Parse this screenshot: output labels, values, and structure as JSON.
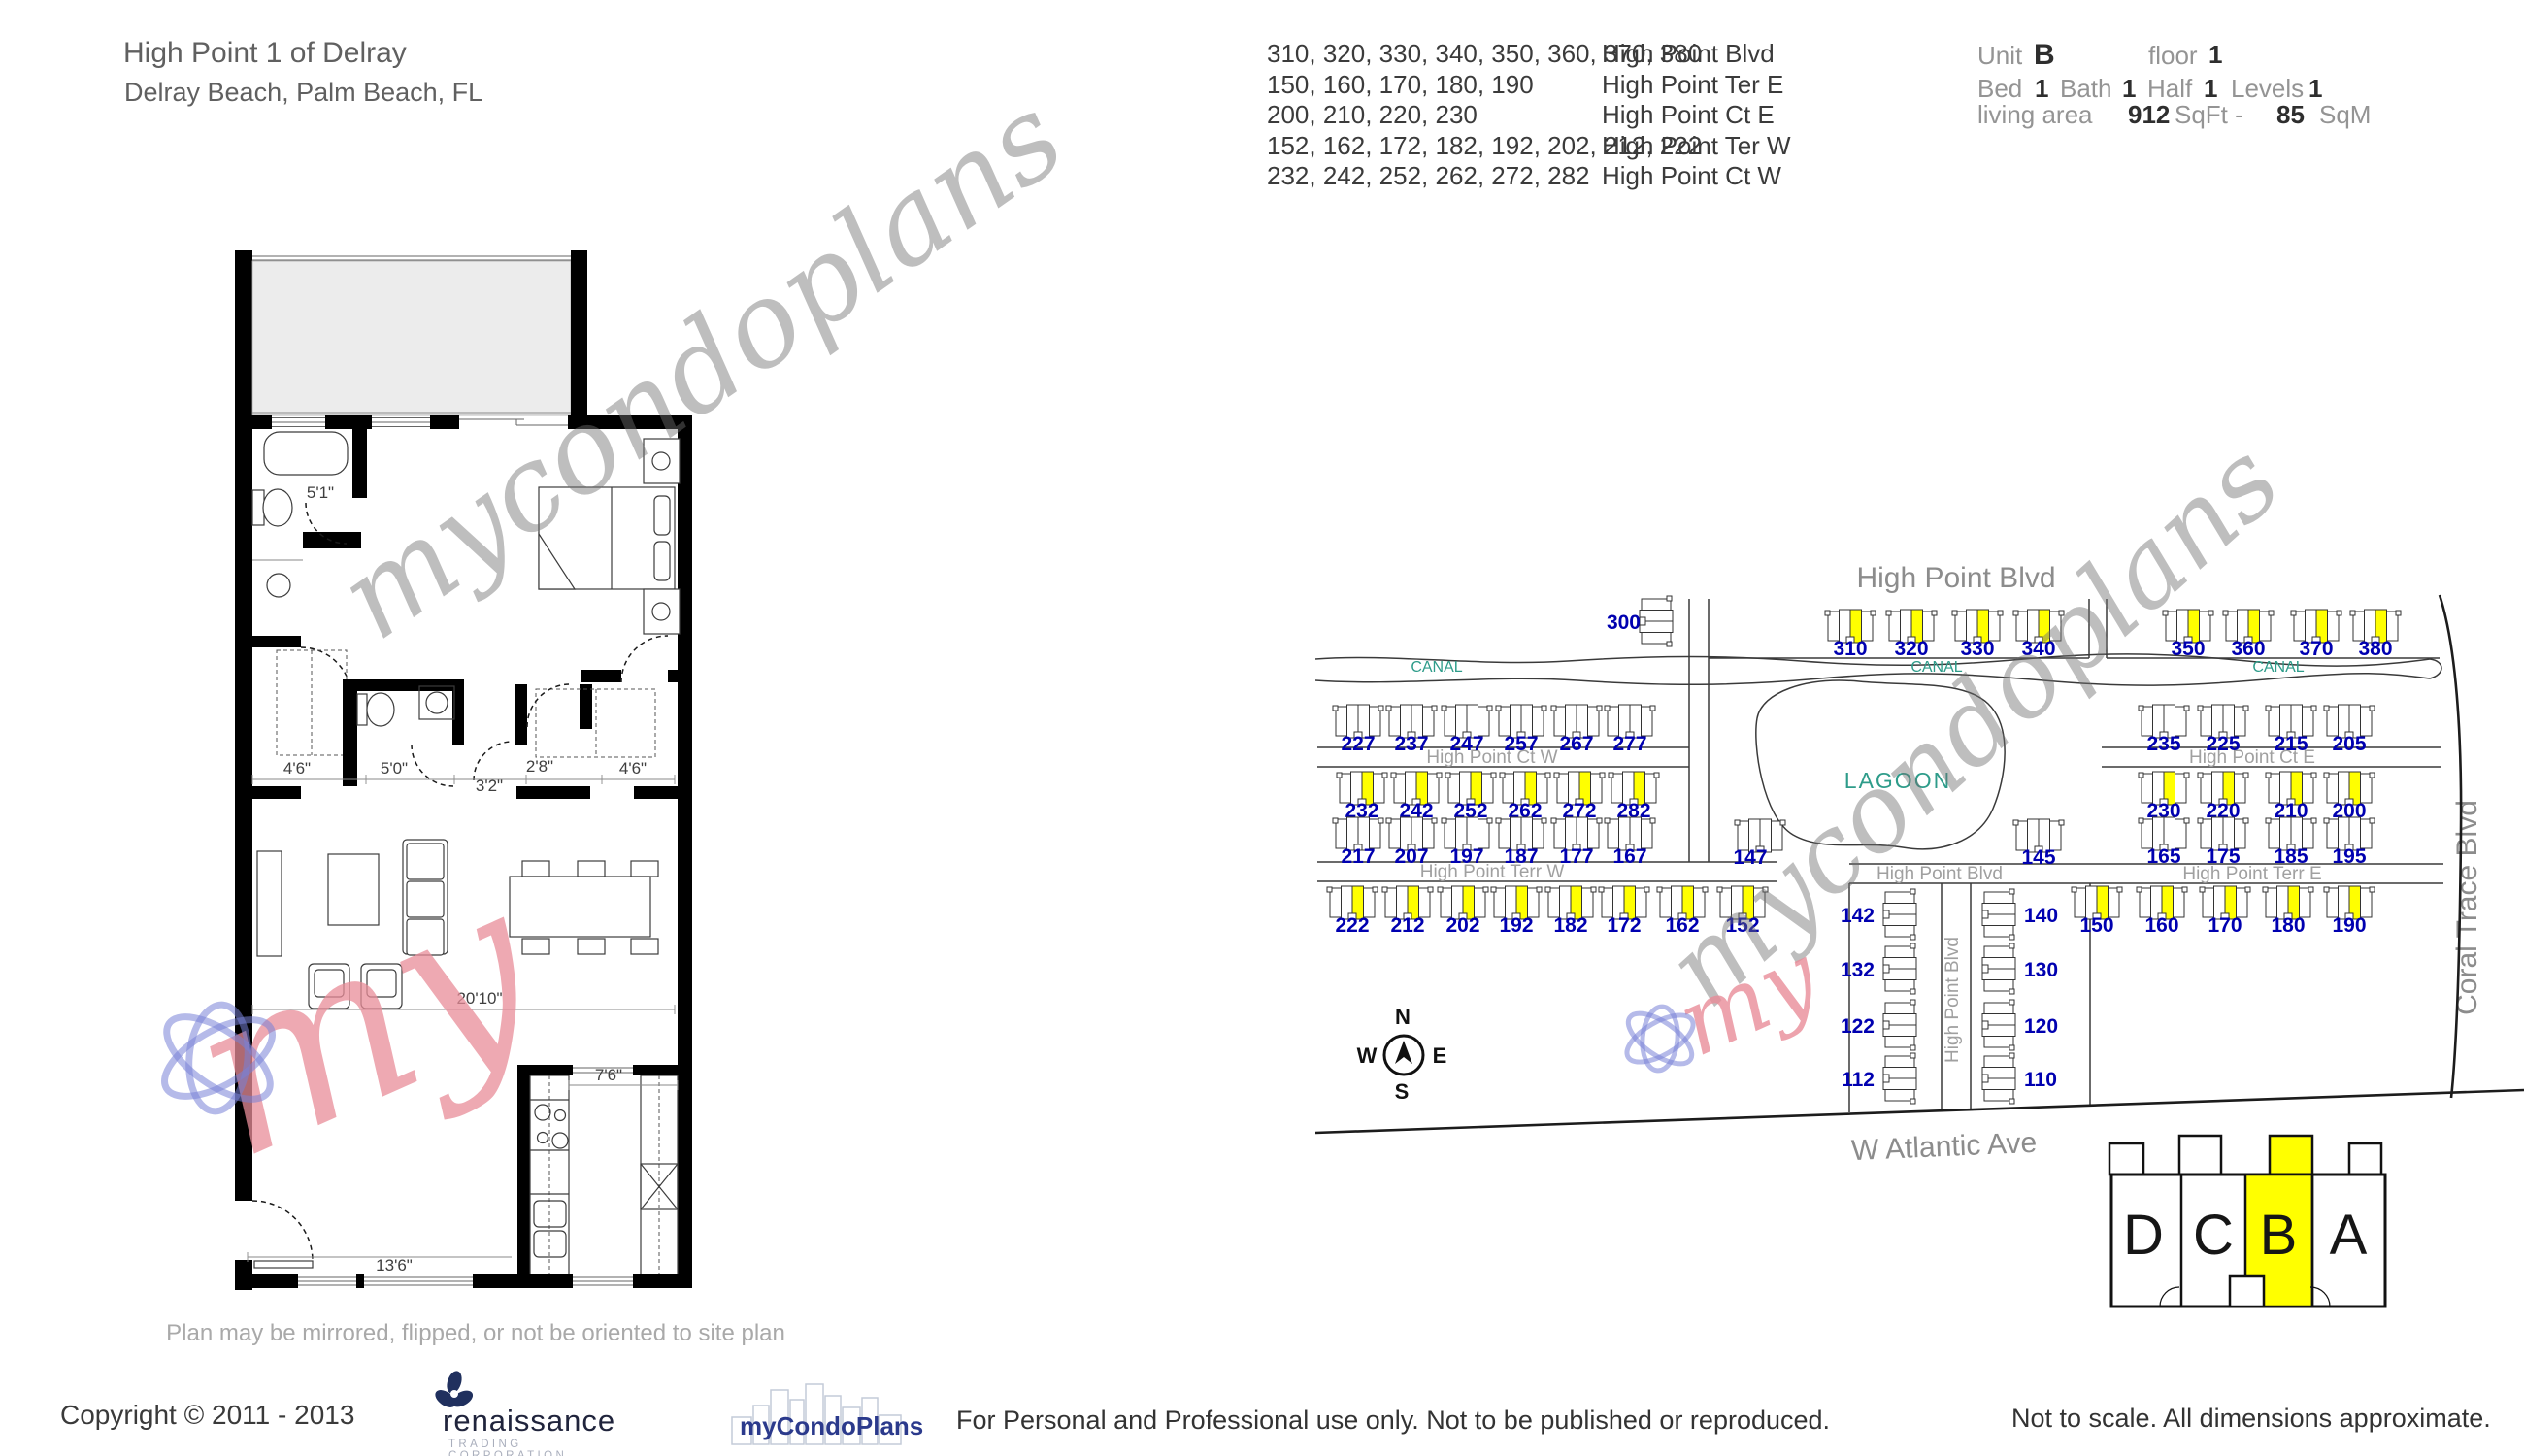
{
  "header": {
    "title": "High Point 1 of Delray",
    "subtitle": "Delray Beach, Palm Beach, FL",
    "address_rows": [
      {
        "numbers": "310, 320, 330, 340, 350, 360, 370, 380",
        "street": "High Point Blvd"
      },
      {
        "numbers": "150, 160, 170, 180, 190",
        "street": "High Point Ter E"
      },
      {
        "numbers": "200, 210, 220, 230",
        "street": "High Point Ct E"
      },
      {
        "numbers": "152, 162, 172, 182, 192, 202, 212, 222",
        "street": "High Point Ter W"
      },
      {
        "numbers": "232, 242, 252, 262, 272, 282",
        "street": "High Point Ct W"
      }
    ],
    "unit_info": {
      "unit_label": "Unit",
      "unit_value": "B",
      "floor_label": "floor",
      "floor_value": "1",
      "bed_label": "Bed",
      "bed_value": "1",
      "bath_label": "Bath",
      "bath_value": "1",
      "half_label": "Half",
      "half_value": "1",
      "levels_label": "Levels",
      "levels_value": "1",
      "living_area_label": "living area",
      "sqft_value": "912",
      "sqft_unit": "SqFt -",
      "sqm_value": "85",
      "sqm_unit": "SqM"
    }
  },
  "floor_plan": {
    "dims": {
      "bath": "5'1\"",
      "closet_left": "4'6\"",
      "half_bath": "5'0\"",
      "hall": "3'2\"",
      "closet_mid": "2'8\"",
      "closet_right": "4'6\"",
      "living": "20'10\"",
      "kitchen": "7'6\"",
      "entry": "13'6\""
    },
    "note": "Plan may be mirrored, flipped, or not be oriented to site plan"
  },
  "site_map": {
    "big_labels": {
      "top_street": "High Point Blvd",
      "bottom_street": "W Atlantic Ave",
      "right_street": "Coral Trace Blvd"
    },
    "street_labels": {
      "ct_w": "High Point Ct W",
      "ter_w": "High Point Terr W",
      "ct_e": "High Point Ct E",
      "ter_e": "High Point Terr E",
      "blvd_h": "High Point Blvd",
      "blvd_v": "High Point Blvd"
    },
    "water_labels": {
      "canal": "CANAL",
      "lagoon": "LAGOON"
    },
    "colors": {
      "number_blue": "#0000b0",
      "highlight_yellow": "#ffff00",
      "water_teal": "#2e9c8a"
    },
    "building_rows": [
      {
        "id": "L1",
        "nums": [
          "227",
          "237",
          "247",
          "257",
          "267",
          "277"
        ],
        "highlighted": false
      },
      {
        "id": "L2",
        "nums": [
          "232",
          "242",
          "252",
          "262",
          "272",
          "282"
        ],
        "highlighted": true
      },
      {
        "id": "L3",
        "nums": [
          "217",
          "207",
          "197",
          "187",
          "177",
          "167"
        ],
        "highlighted": false
      },
      {
        "id": "L4",
        "nums": [
          "222",
          "212",
          "202",
          "192",
          "182",
          "172",
          "162",
          "152"
        ],
        "highlighted": true
      },
      {
        "id": "M1",
        "nums": [
          "310",
          "320",
          "330",
          "340"
        ],
        "highlighted": true
      },
      {
        "id": "R1",
        "nums": [
          "350",
          "360",
          "370",
          "380"
        ],
        "highlighted": true
      },
      {
        "id": "R2",
        "nums": [
          "235",
          "225",
          "215",
          "205"
        ],
        "highlighted": false
      },
      {
        "id": "R3",
        "nums": [
          "230",
          "220",
          "210",
          "200"
        ],
        "highlighted": true
      },
      {
        "id": "R4",
        "nums": [
          "165",
          "175",
          "185",
          "195"
        ],
        "highlighted": false
      },
      {
        "id": "R5",
        "nums": [
          "150",
          "160",
          "170",
          "180",
          "190"
        ],
        "highlighted": true
      }
    ],
    "single_buildings": [
      {
        "id": "B300",
        "num": "300"
      },
      {
        "id": "B147",
        "num": "147"
      },
      {
        "id": "B145",
        "num": "145"
      }
    ],
    "vertical_columns": {
      "left": [
        "142",
        "132",
        "122",
        "112"
      ],
      "right": [
        "140",
        "130",
        "120",
        "110"
      ]
    },
    "compass": {
      "n": "N",
      "e": "E",
      "s": "S",
      "w": "W"
    }
  },
  "building_key": {
    "units": [
      "D",
      "C",
      "B",
      "A"
    ],
    "highlighted": "B"
  },
  "footer": {
    "copyright": "Copyright © 2011 - 2013",
    "renaissance_name": "renaissance",
    "renaissance_tagline": "TRADING CORPORATION",
    "mycondoplans": "myCondoPlans",
    "usage": "For Personal and  Professional use only.  Not to be published or reproduced.",
    "scale_note": "Not to scale.  All dimensions approximate."
  },
  "watermarks": {
    "script": "mycondoplans",
    "small": "my"
  }
}
